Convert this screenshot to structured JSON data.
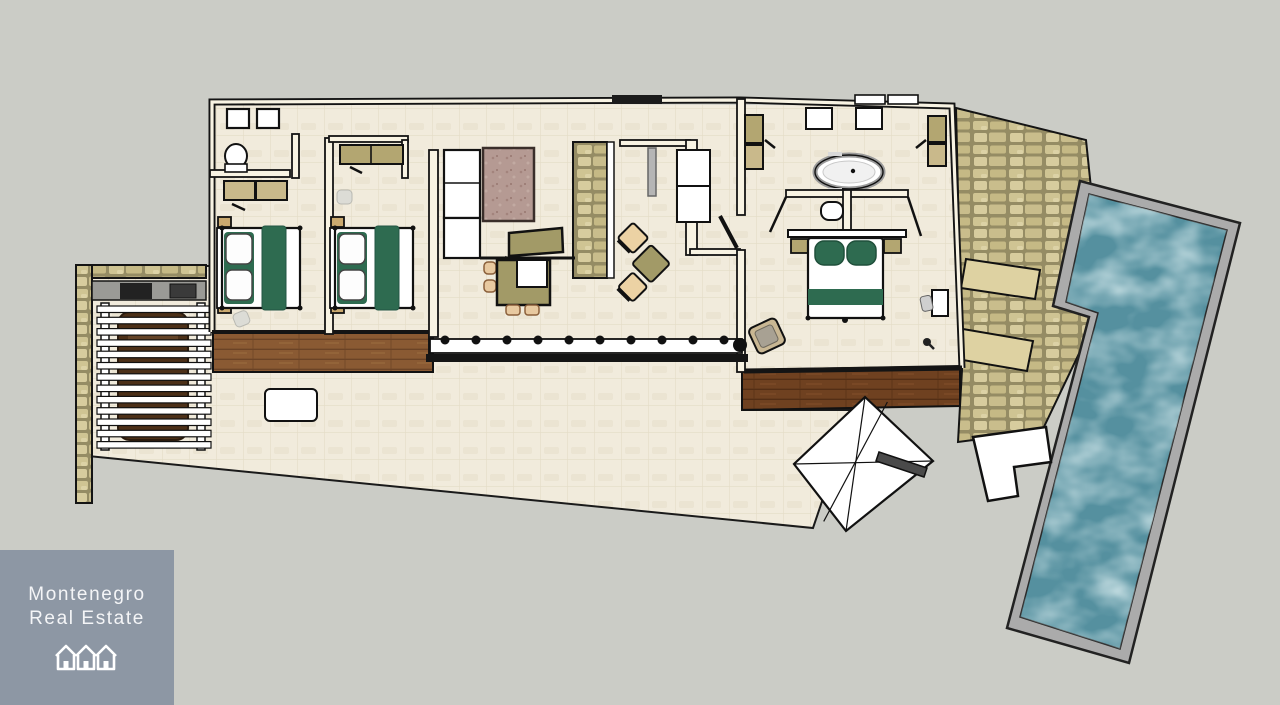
{
  "brand": {
    "line1": "Montenegro",
    "line2": "Real Estate",
    "icon": "houses-icon",
    "background": "#8d97a4",
    "text_color": "#f4f5f7"
  },
  "scene": {
    "type": "real-estate-floor-plan",
    "background": "#cbccc6"
  },
  "palette": {
    "floor_tile": "#f1ebdc",
    "wall_fill": "#f8f3e3",
    "wall_outline": "#141414",
    "wood_deck_light": "#8a5a33",
    "wood_deck_dark": "#6f4120",
    "stone_patio": "#cfc493",
    "pool_water": "#55909f",
    "pool_coping": "#ababab",
    "bedding_green": "#2e6b50",
    "furniture_tan": "#c9b98b",
    "kitchen_olive": "#a29a67",
    "rug_mauve": "#b59a93",
    "carport_header": "#9a9a96"
  },
  "features": [
    "bathroom",
    "bedroom-1",
    "bedroom-2",
    "hallway",
    "living-room",
    "kitchen",
    "master-bedroom",
    "master-bathtub",
    "sliding-glass-door",
    "wood-deck-left",
    "wood-deck-right",
    "carport-pergola",
    "stone-patio",
    "sun-loungers",
    "swimming-pool",
    "pool-steps",
    "patio-umbrella"
  ]
}
